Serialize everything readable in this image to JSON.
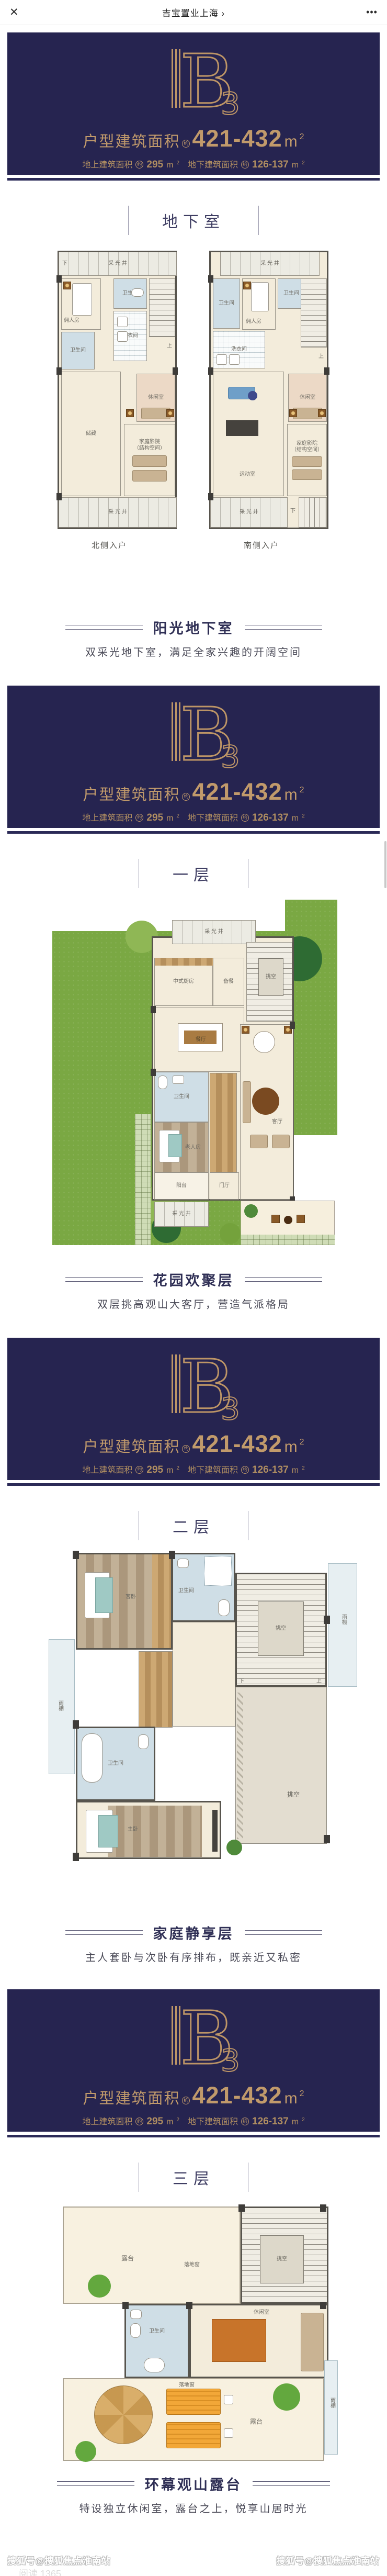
{
  "topbar": {
    "close": "✕",
    "title": "吉宝置业上海 ›",
    "more": "•••"
  },
  "banner": {
    "logo_b": "B",
    "logo_3": "3",
    "line1_label": "户型建筑面积",
    "approx": "约",
    "line1_value": "421-432",
    "unit": "m",
    "sup": "2",
    "line2a_label": "地上建筑面积",
    "line2a_value": "295",
    "line2b_label": "地下建筑面积",
    "line2b_value": "126-137",
    "navy": "#262450",
    "gold": "#bd9566"
  },
  "sections": [
    {
      "heading": "地下室",
      "caption": "阳光地下室",
      "subtitle": "双采光地下室，满足全家兴趣的开阔空间"
    },
    {
      "heading": "一层",
      "caption": "花园欢聚层",
      "subtitle": "双层挑高观山大客厅，营造气派格局"
    },
    {
      "heading": "二层",
      "caption": "家庭静享层",
      "subtitle": "主人套卧与次卧有序排布，既亲近又私密"
    },
    {
      "heading": "三层",
      "caption": "环幕观山露台",
      "subtitle": "特设独立休闲室，露台之上，悦享山居时光"
    }
  ],
  "plans": {
    "bl": {
      "lw": "采 光 井",
      "down": "下",
      "up": "上",
      "maid": "佣人房",
      "bath1": "卫生间",
      "bath2": "卫生间",
      "laundry": "洗衣间",
      "leisure": "休闲室",
      "storage": "储藏",
      "cinema1": "家庭影院",
      "cinema2": "（结构空间）",
      "lwb": "采 光 井",
      "entry": "北侧入户"
    },
    "br": {
      "lw": "采 光 井",
      "down": "下",
      "up": "上",
      "maid": "佣人房",
      "bath1": "卫生间",
      "bath2": "卫生间",
      "laundry": "洗衣间",
      "leisure": "休闲室",
      "gym": "运动室",
      "cinema1": "家庭影院",
      "cinema2": "（结构空间）",
      "lwb": "采 光 井",
      "entry": "南侧入户"
    },
    "f1": {
      "lw": "采 光 井",
      "kitchen": "中式厨房",
      "prep": "备餐",
      "dining": "餐厅",
      "void": "挑空",
      "living": "客厅",
      "bath": "卫生间",
      "elder": "老人房",
      "balcony": "阳台",
      "foyer": "门厅",
      "lwb": "采 光 井",
      "down": "下",
      "up": "上"
    },
    "f2": {
      "guest": "客卧",
      "bath1": "卫生间",
      "void1": "挑空",
      "canopyL": "雨棚",
      "bath2": "卫生间",
      "master": "主卧",
      "void2": "挑空",
      "canopyR": "雨棚",
      "down": "下",
      "up": "上"
    },
    "f3": {
      "terrace1": "露台",
      "terrace2": "露台",
      "void": "挑空",
      "bath": "卫生间",
      "lounge": "休闲室",
      "window1": "落地窗",
      "window2": "落地窗",
      "canopy": "雨棚",
      "down": "下"
    }
  },
  "watermark": {
    "left": "搜狐号@搜狐焦点淮南站",
    "right": "搜狐号@搜狐焦点淮南站",
    "reads": "阅读 1365"
  }
}
